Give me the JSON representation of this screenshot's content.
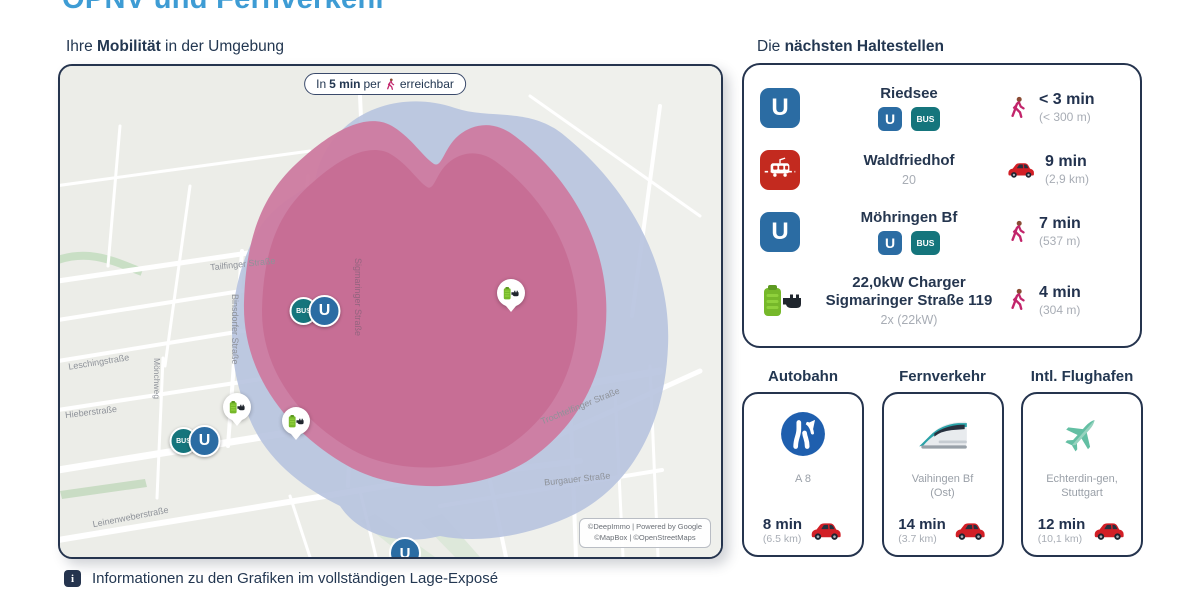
{
  "title": "ÖPNV und Fernverkehr",
  "map": {
    "heading": {
      "pre": "Ihre ",
      "bold": "Mobilität",
      "post": " in der Umgebung"
    },
    "pill": {
      "pre": "In ",
      "bold": "5 min",
      "mid": " per ",
      "post": " erreichbar"
    },
    "street_labels": [
      "Tailfinger Straße",
      "Binsdorfer Straße",
      "Leschingstraße",
      "Hieberstraße",
      "Mönchweg",
      "Sigmaringer Straße",
      "Trochtelfinger Straße",
      "Burgauer Straße",
      "Leinenweberstraße"
    ],
    "attribution": {
      "line1": "©DeepImmo | Powered by Google",
      "line2": "©MapBox | ©OpenStreetMaps"
    }
  },
  "icons": {
    "u_letter": "U",
    "bus_label": "BUS",
    "info_glyph": "i"
  },
  "stops": {
    "heading": {
      "pre": "Die ",
      "bold": "nächsten Haltestellen"
    },
    "rows": [
      {
        "name": "Riedsee",
        "time": "< 3 min",
        "distance": "(< 300 m)",
        "mode": "walk"
      },
      {
        "name": "Waldfriedhof",
        "sub": "20",
        "time": "9 min",
        "distance": "(2,9 km)",
        "mode": "car"
      },
      {
        "name": "Möhringen Bf",
        "time": "7 min",
        "distance": "(537 m)",
        "mode": "walk"
      },
      {
        "name": "22,0kW Charger Sigmaringer Straße 119",
        "sub": "2x (22kW)",
        "time": "4 min",
        "distance": "(304 m)",
        "mode": "walk"
      }
    ]
  },
  "transport_cards": [
    {
      "heading": "Autobahn",
      "name": "A 8",
      "time": "8 min",
      "distance": "(6.5 km)"
    },
    {
      "heading": "Fernverkehr",
      "name": "Vaihingen Bf (Ost)",
      "time": "14 min",
      "distance": "(3.7 km)"
    },
    {
      "heading": "Intl. Flughafen",
      "name": "Echterdin-gen, Stuttgart",
      "time": "12 min",
      "distance": "(10,1 km)"
    }
  ],
  "footer": {
    "note": "Informationen zu den Grafiken im vollständigen Lage-Exposé"
  },
  "colors": {
    "accent_blue": "#3E9CD4",
    "navy": "#25344E",
    "ubahn_blue": "#2B6CA3",
    "bus_teal": "#15757C",
    "tram_red": "#C32A1F",
    "charger_green": "#76B82A",
    "walk_magenta": "#C2256B",
    "car_red": "#D21F26",
    "reach_pink": "#C76D95",
    "reach_blue": "#B7C3DF",
    "map_bg": "#ECEDE8"
  }
}
